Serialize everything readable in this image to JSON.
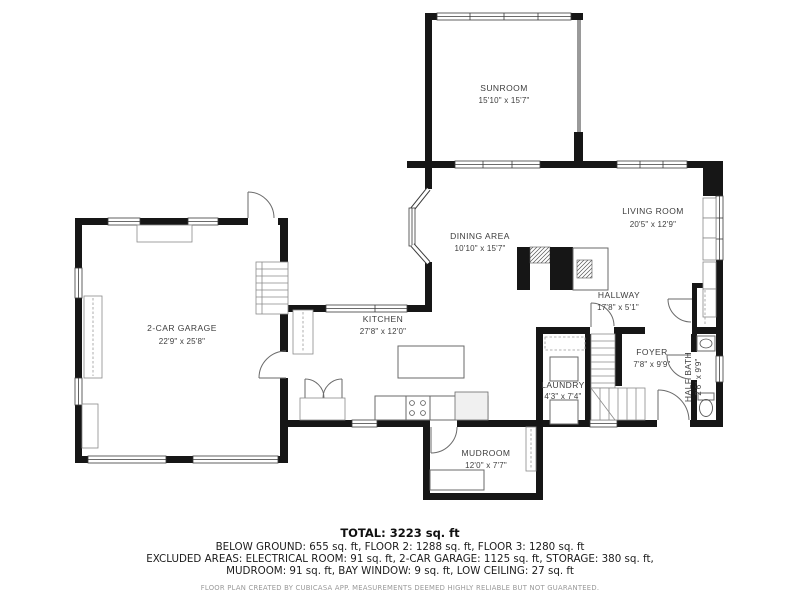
{
  "plan": {
    "rooms": {
      "sunroom": {
        "name": "SUNROOM",
        "dims": "15'10\" x 15'7\""
      },
      "living_room": {
        "name": "LIVING ROOM",
        "dims": "20'5\" x 12'9\""
      },
      "dining_area": {
        "name": "DINING AREA",
        "dims": "10'10\" x 15'7\""
      },
      "kitchen": {
        "name": "KITCHEN",
        "dims": "27'8\" x 12'0\""
      },
      "garage": {
        "name": "2-CAR GARAGE",
        "dims": "22'9\" x 25'8\""
      },
      "hallway": {
        "name": "HALLWAY",
        "dims": "17'8\" x 5'1\""
      },
      "foyer": {
        "name": "FOYER",
        "dims": "7'8\" x 9'9\""
      },
      "laundry": {
        "name": "LAUNDRY",
        "dims": "4'3\" x 7'4\""
      },
      "half_bath": {
        "name": "HALF BATH",
        "dims": "2'6\" x 9'9\""
      },
      "mudroom": {
        "name": "MUDROOM",
        "dims": "12'0\" x 7'7\""
      }
    },
    "summary": {
      "total": "TOTAL: 3223 sq. ft",
      "line1": "BELOW GROUND: 655 sq. ft, FLOOR 2: 1288 sq. ft, FLOOR 3: 1280 sq. ft",
      "line2": "EXCLUDED AREAS: ELECTRICAL ROOM: 91 sq. ft, 2-CAR GARAGE: 1125 sq. ft, STORAGE: 380 sq. ft,",
      "line3": "MUDROOM: 91 sq. ft, BAY WINDOW: 9 sq. ft, LOW CEILING: 27 sq. ft",
      "disclaimer": "FLOOR PLAN CREATED BY CUBICASA APP. MEASUREMENTS DEEMED HIGHLY RELIABLE BUT NOT GUARANTEED."
    },
    "colors": {
      "wall": "#161616",
      "background": "#ffffff",
      "accent_line": "#6a6a6a"
    }
  }
}
